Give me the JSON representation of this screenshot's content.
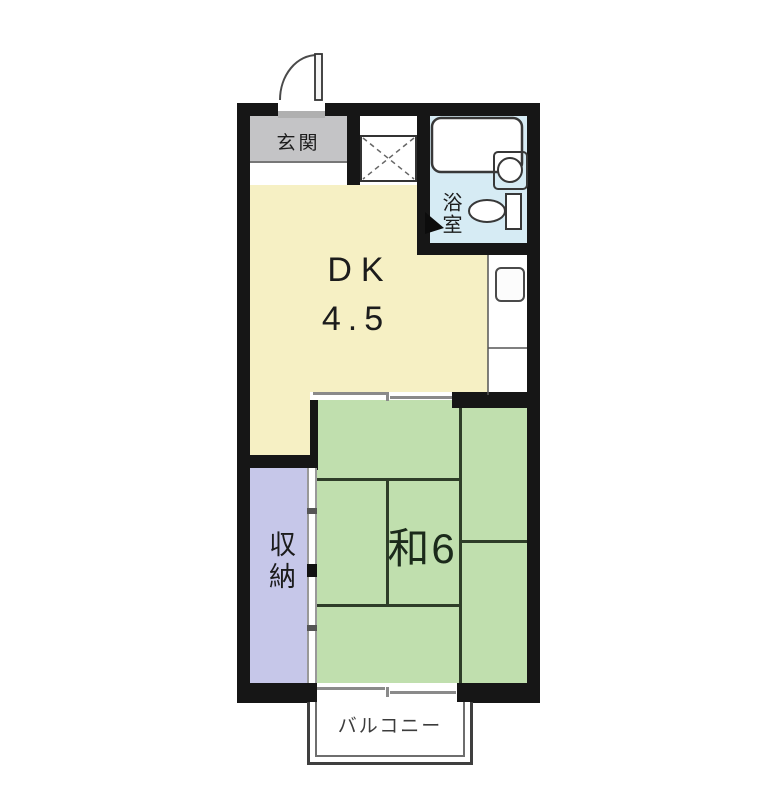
{
  "floorplan": {
    "entrance": {
      "label": "玄関"
    },
    "bathroom": {
      "label": "浴室"
    },
    "dining_kitchen": {
      "label": "DK",
      "size": "4.5"
    },
    "japanese_room": {
      "label": "和6"
    },
    "storage": {
      "label": "収納"
    },
    "balcony": {
      "label": "バルコニー"
    }
  },
  "colors": {
    "wall": "#161616",
    "dk_fill": "#f6f0c4",
    "tatami_fill": "#c0dfae",
    "storage_fill": "#c6c7e9",
    "bathroom_fill": "#d6ebf4",
    "entrance_fill": "#c4c4c6",
    "step_line": "#777777",
    "tatami_line": "#2e3d28",
    "door_line": "#8a8a8a",
    "threshold": "#b0b0b0",
    "door_tick_dark": "#111111",
    "door_tick_gray": "#555555",
    "balcony_line": "#3f3f3f",
    "balcony_inner_line": "#6e6e6e",
    "text": "#1c1c1c",
    "tatami_text": "#1b2a1b",
    "balcony_text": "#3c3c3c"
  }
}
